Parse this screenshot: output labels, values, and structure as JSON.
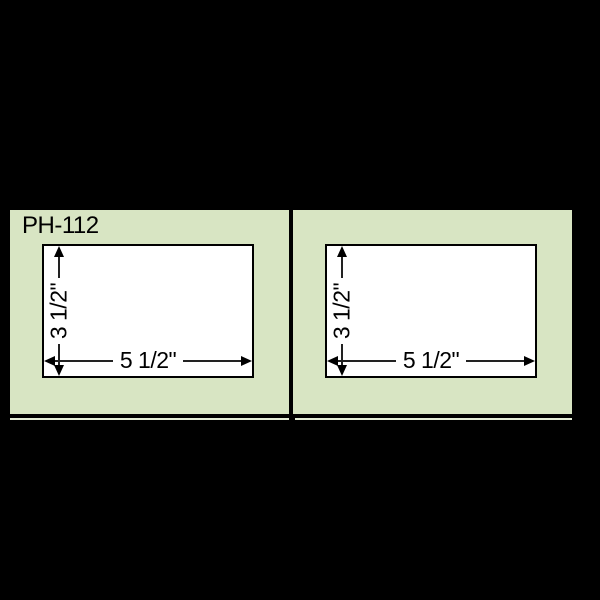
{
  "product": {
    "code": "PH-112"
  },
  "colors": {
    "background": "#000000",
    "panel_green": "#d8e5c3",
    "line_black": "#000000",
    "pocket_white": "#ffffff",
    "sliver_green": "#e3ecd5"
  },
  "panels": [
    {
      "id": "left",
      "label": "PH-112",
      "pocket": {
        "height_label": "3 1/2\"",
        "width_label": "5 1/2\""
      }
    },
    {
      "id": "right",
      "pocket": {
        "height_label": "3 1/2\"",
        "width_label": "5 1/2\""
      }
    }
  ]
}
